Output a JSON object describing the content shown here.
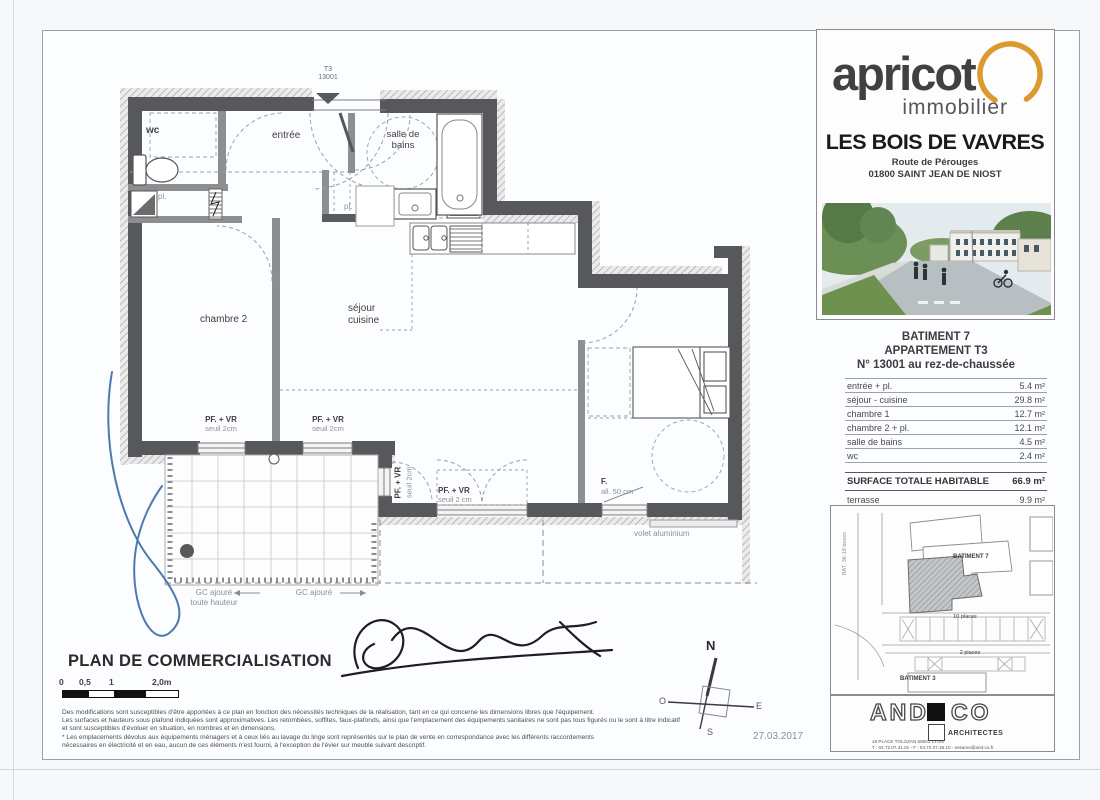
{
  "branding": {
    "logo": "apricot",
    "logo_sub": "immobilier",
    "project": "LES BOIS DE VAVRES",
    "address1": "Route de Pérouges",
    "address2": "01800 SAINT JEAN DE NIOST"
  },
  "apartment": {
    "building": "BATIMENT 7",
    "type_label": "APPARTEMENT T3",
    "number_label": "N° 13001 au rez-de-chaussée",
    "rows": [
      {
        "label": "entrée + pl.",
        "area": "5.4 m²"
      },
      {
        "label": "séjour - cuisine",
        "area": "29.8 m²"
      },
      {
        "label": "chambre 1",
        "area": "12.7 m²"
      },
      {
        "label": "chambre 2 + pl.",
        "area": "12.1 m²"
      },
      {
        "label": "salle de bains",
        "area": "4.5 m²"
      },
      {
        "label": "wc",
        "area": "2.4 m²"
      }
    ],
    "total_label": "SURFACE TOTALE HABITABLE",
    "total_area": "66.9 m²",
    "terrace_label": "terrasse",
    "terrace_area": "9.9 m²"
  },
  "plan": {
    "unit_tag": "T3\n13001",
    "labels": {
      "wc": "wc",
      "entree": "entrée",
      "salle_de_bains": "salle de\nbains",
      "chambre2": "chambre 2",
      "sejour": "séjour\ncuisine",
      "chambre1": "chambre 1",
      "terrasse": "terrasse",
      "ll": "LL",
      "lv": "LV",
      "cui": "Cui",
      "fr": "FR",
      "pl": "pl.",
      "pf_vr": "PF. + VR",
      "seuil_2cm": "seuil 2cm",
      "seuil_2_cm": "seuil 2 cm",
      "f": "F.",
      "all_50": "all. 50 cm",
      "volet": "volet aluminium",
      "gc_ajoure": "GC ajouré",
      "toute_hauteur": "toute hauteur"
    }
  },
  "titleblock": {
    "title": "PLAN DE COMMERCIALISATION",
    "scale_ticks": [
      "0",
      "0,5",
      "1",
      "2,0m"
    ],
    "legal": [
      "Des modifications sont susceptibles d'être apportées à ce plan en fonction des nécessités techniques de la réalisation, tant en ce qui concerne les dimensions libres que l'équipement.",
      "Les surfaces et hauteurs sous plafond indiquées sont approximatives. Les retombées, soffites, faux-plafonds, ainsi que l'emplacement des équipements sanitaires ne sont pas tous figurés ou le sont à titre indicatif",
      "et sont susceptibles d'évoluer en situation, en nombres et en dimensions.",
      "* Les emplacements dévolus aux équipements ménagers et à ceux liés au lavage du linge sont représentés sur le plan de vente en correspondance avec les différents raccordements",
      "nécessaires en électricité et en eau, aucun de ces éléments n'est fourni, à l'exception de l'évier sur meuble suivant descriptif."
    ],
    "date": "27.03.2017"
  },
  "compass": {
    "n": "N",
    "s": "S",
    "e": "E",
    "o": "O"
  },
  "siteplan": {
    "batiment7": "BATIMENT 7",
    "batiment3": "BATIMENT 3",
    "places10": "10 places",
    "places2": "2 places",
    "bat_side": "BAT. 36-18 boxes"
  },
  "architect": {
    "name_left": "AND",
    "name_right": "CO",
    "subtitle": "ARCHITECTES",
    "addr1": "18 PLACE TOLOZAN 69001 LYON",
    "addr2": "T : 04.72.07.41.01 - F : 04.72.07.46.10 - sesame@and-co.fr"
  },
  "colors": {
    "accent_orange": "#dc9a2e",
    "wall_gray": "#57585b",
    "teal_dash": "#7fa39b",
    "blue_ink": "#3a6ba5"
  }
}
